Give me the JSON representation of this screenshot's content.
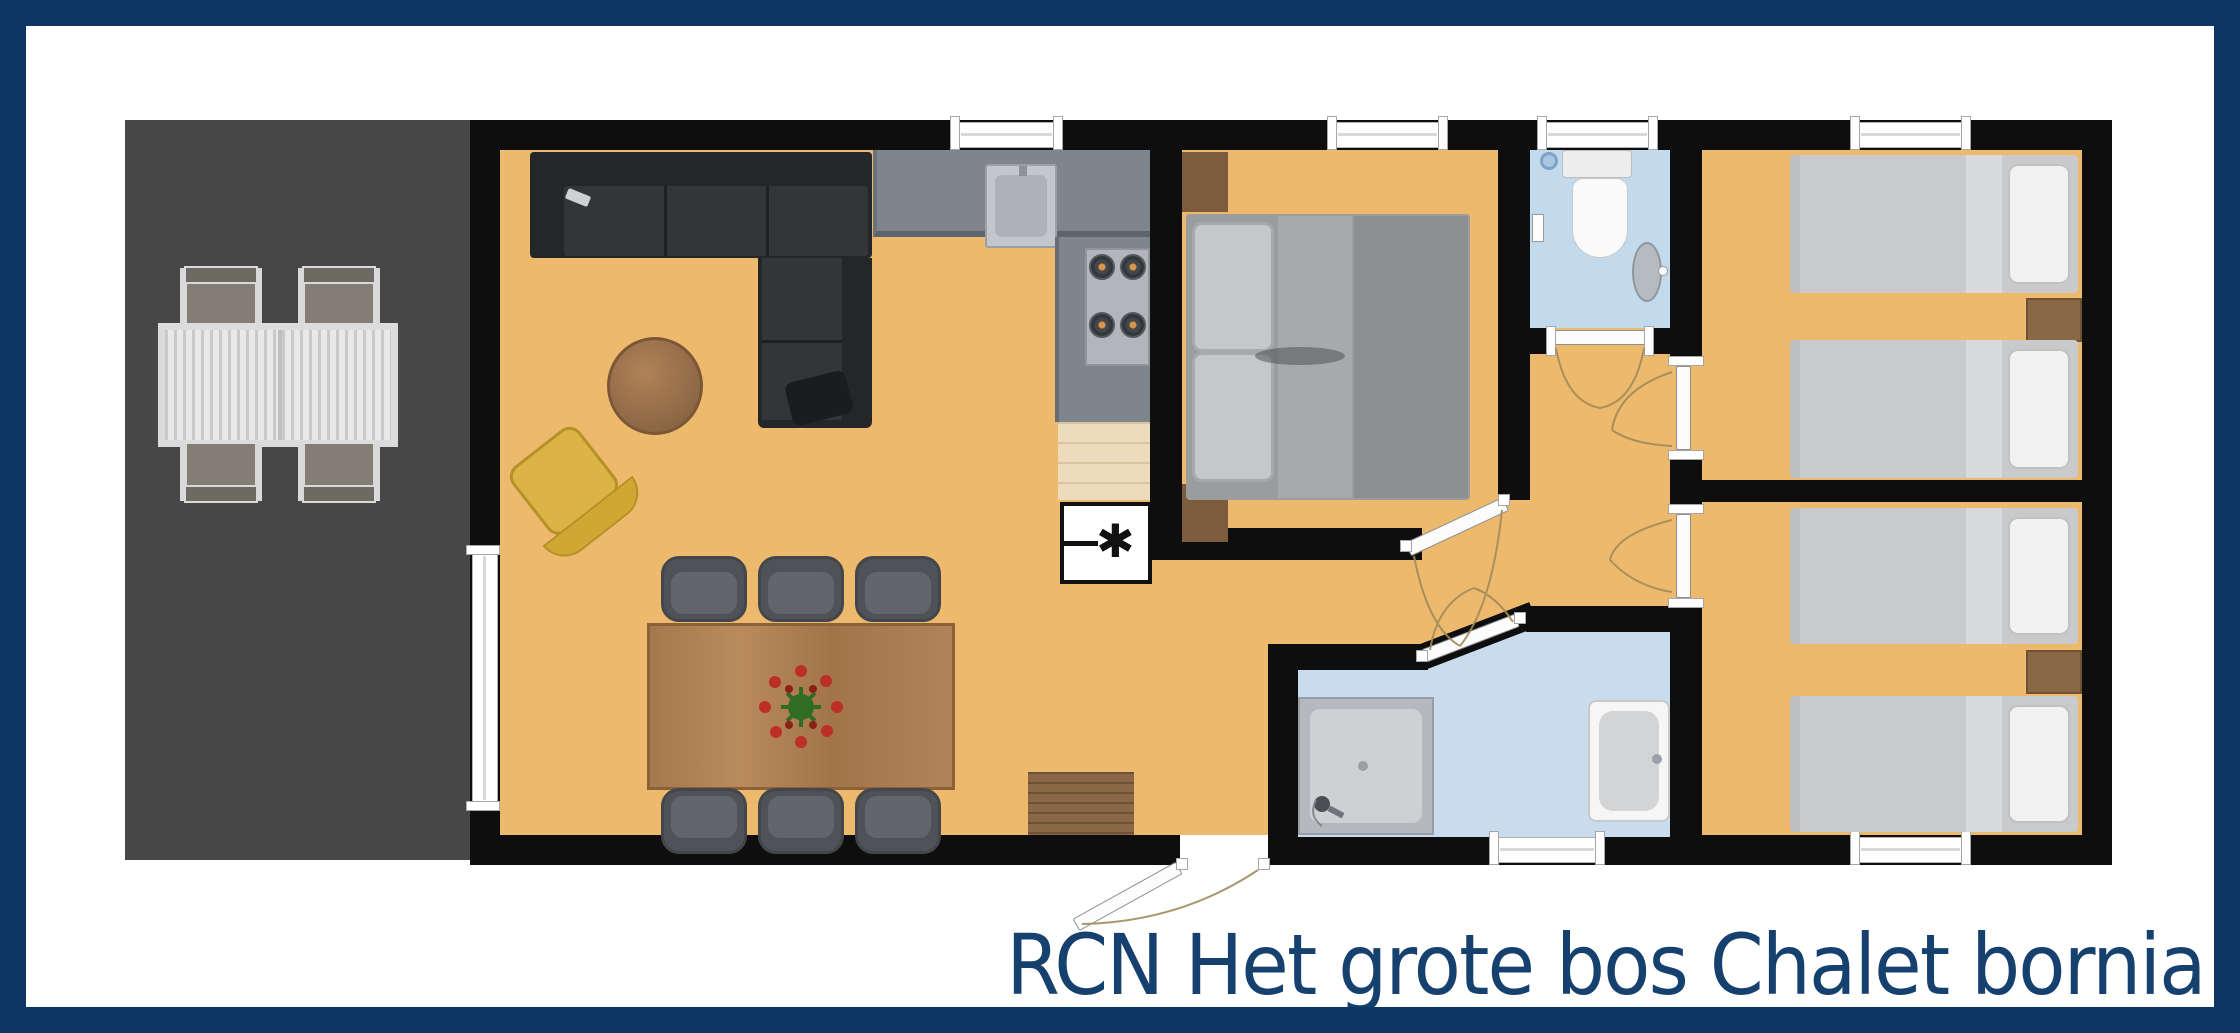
{
  "caption": {
    "text": "RCN Het grote bos Chalet bornia"
  },
  "symbols": {
    "heater": "✱"
  },
  "colors": {
    "frame_navy": "#0d3563",
    "caption_navy": "#16406e",
    "floor_tan": "#edb96c",
    "terrace_gray": "#474747",
    "wall_black": "#0e0e0e",
    "bath_blue": "#c9dcee",
    "toilet_blue": "#c3d9ec",
    "counter_gray": "#7e858c",
    "wood_brown": "#a5794e",
    "sofa_charcoal": "#2b2c2e",
    "chair_yellow": "#dcb345"
  },
  "rooms": [
    {
      "name": "terrace"
    },
    {
      "name": "living-room"
    },
    {
      "name": "kitchen"
    },
    {
      "name": "master-bedroom"
    },
    {
      "name": "toilet-room"
    },
    {
      "name": "hallway"
    },
    {
      "name": "bathroom"
    },
    {
      "name": "bedroom-2"
    },
    {
      "name": "bedroom-3"
    }
  ]
}
